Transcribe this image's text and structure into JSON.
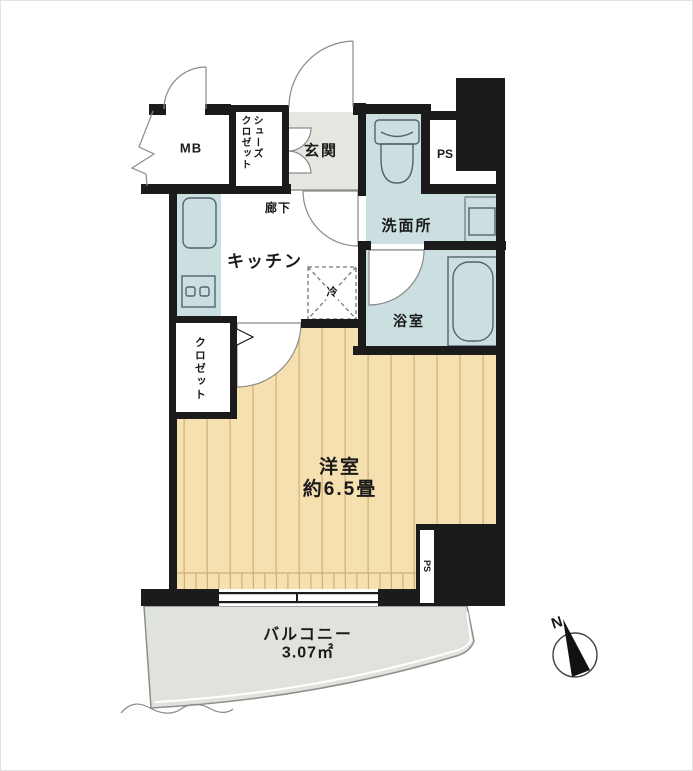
{
  "floorplan": {
    "labels": {
      "mb": "MB",
      "shoes_closet_line1": "シューズ",
      "shoes_closet_line2": "クロゼット",
      "entrance": "玄関",
      "hallway": "廊下",
      "kitchen": "キッチン",
      "refrigerator": "冷",
      "washroom": "洗面所",
      "bathroom": "浴室",
      "closet": "クロゼット",
      "room_name": "洋室",
      "room_size": "約6.5畳",
      "ps_upper": "PS",
      "ps_lower": "PS",
      "balcony_name": "バルコニー",
      "balcony_area": "3.07㎡",
      "compass_north": "N"
    },
    "colors": {
      "wall": "#1b1b1b",
      "water_blue": "#cbdfe1",
      "entrance_gray": "#e4e6e0",
      "wood": "#f5e0af",
      "wood_stripe": "#d2ae74",
      "balcony_gray": "#e0e3dd",
      "line": "#8a8a8a"
    }
  }
}
